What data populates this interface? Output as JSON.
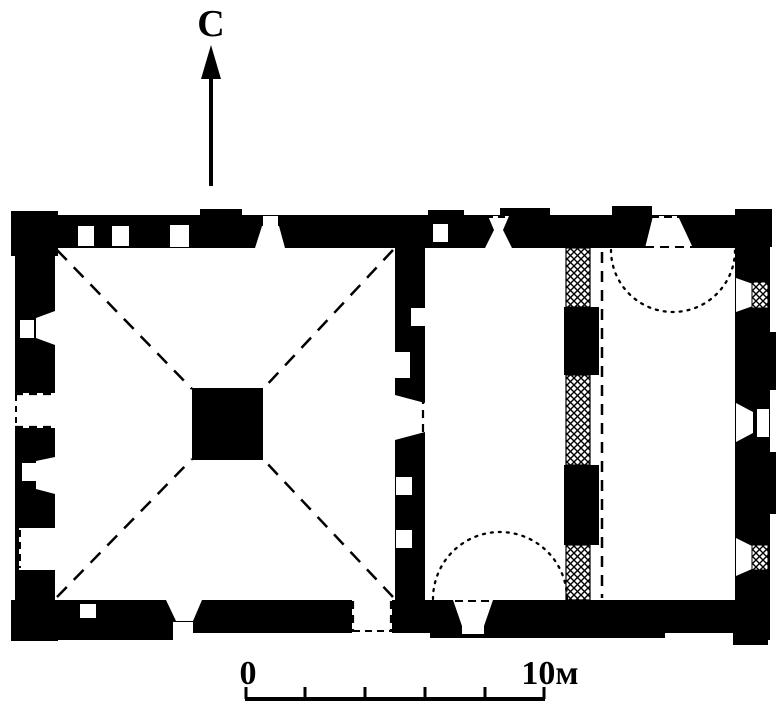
{
  "labels": {
    "north": "С",
    "scale_start": "0",
    "scale_end": "10м"
  },
  "colors": {
    "ink": "#000000",
    "paper": "#ffffff"
  },
  "icons": {
    "north_arrow": "up-arrow",
    "hatch": "crosshatch-masonry"
  },
  "scale_bar": {
    "start_value": "0",
    "end_value": "10м",
    "tick_count": 6,
    "segment_count": 5
  }
}
